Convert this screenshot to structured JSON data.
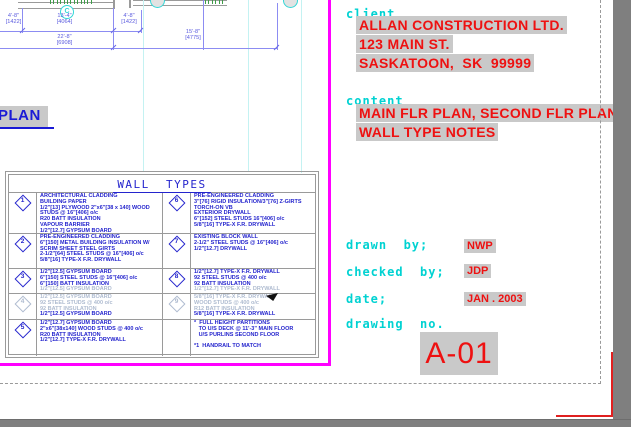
{
  "plan": {
    "title": "PLAN",
    "grid_bubble_label": "C",
    "dimensions": [
      {
        "label": "4'-8\"",
        "mm": "[1422]",
        "x": 0,
        "y": 13,
        "w": 27
      },
      {
        "label": "13'-4\"",
        "mm": "[4064]",
        "x": 42,
        "y": 13,
        "w": 45
      },
      {
        "label": "4'-8\"",
        "mm": "[1422]",
        "x": 115,
        "y": 13,
        "w": 28
      },
      {
        "label": "22'-8\"",
        "mm": "[6908]",
        "x": 42,
        "y": 34,
        "w": 45
      },
      {
        "label": "15'-8\"",
        "mm": "[4775]",
        "x": 170,
        "y": 29,
        "w": 46
      }
    ]
  },
  "wall_types": {
    "title": "WALL  TYPES",
    "rows": [
      {
        "h": 41,
        "left": {
          "num": "1",
          "lines": [
            {
              "t": "ARCHITECTURAL CLADDING"
            },
            {
              "t": "BUILDING PAPER"
            },
            {
              "t": "1/2\"[13] PLYWOOD 2\"x6\"[38 x 140] WOOD"
            },
            {
              "t": "STUDS @ 16\"[406] o/c"
            },
            {
              "t": "R20 BATT INSULATION"
            },
            {
              "t": "VAPOUR BARRIER"
            },
            {
              "t": "1/2\"[12.7] GYPSUM BOARD"
            }
          ]
        },
        "right": {
          "num": "6",
          "lines": [
            {
              "t": "PRE-ENGINEERED CLADDING"
            },
            {
              "t": "3\"[76] RIGID INSULATION/3\"[76] Z-GIRTS"
            },
            {
              "t": "TORCH-ON VB"
            },
            {
              "t": "EXTERIOR DRYWALL"
            },
            {
              "t": "6\"[152] STEEL STUDS 16\"[406] o/c"
            },
            {
              "t": "5/8\"[16] TYPE-X F.R. DRYWALL"
            }
          ]
        }
      },
      {
        "h": 35,
        "left": {
          "num": "2",
          "lines": [
            {
              "t": "PRE-ENGINEERED CLADDING"
            },
            {
              "t": "6\"[150] METAL BUILDING INSULATION W/"
            },
            {
              "t": "SCRIM SHEET STEEL GIRTS"
            },
            {
              "t": "2-1/2\"[64] STEEL STUDS @ 16\"[406] o/c"
            },
            {
              "t": "5/8\"[16] TYPE-X F.R. DRYWALL"
            }
          ]
        },
        "right": {
          "num": "7",
          "lines": [
            {
              "t": "EXISTING BLOCK WALL"
            },
            {
              "t": "2-1/2\" STEEL STUDS @ 16\"[406] o/c"
            },
            {
              "t": "1/2\"[12.7] DRYWALL"
            }
          ]
        }
      },
      {
        "h": 25,
        "left": {
          "num": "3",
          "lines": [
            {
              "t": "1/2\"[12.5] GYPSUM BOARD"
            },
            {
              "t": "6\"[150] STEEL STUDS @ 16\"[406] o/c"
            },
            {
              "t": "6\"[150] BATT INSULATION"
            },
            {
              "t": "1/2\"[12.5] GYPSUM BOARD",
              "f": true
            }
          ]
        },
        "right": {
          "num": "8",
          "lines": [
            {
              "t": "1/2\"[12.7] TYPE-X F.R. DRYWALL"
            },
            {
              "t": "92 STEEL STUDS @ 400 o/c"
            },
            {
              "t": "92 BATT INSULATION"
            },
            {
              "t": "1/2\"[12.7] TYPE-X F.R. DRYWALL",
              "f": true
            }
          ]
        }
      },
      {
        "h": 26,
        "left": {
          "num": "4",
          "num_faded": true,
          "lines": [
            {
              "t": "1/2\"[12.5] GYPSUM BOARD",
              "f": true
            },
            {
              "t": "92 STEEL STUDS @ 400 o/c",
              "f": true
            },
            {
              "t": "92 BATT INSULATION",
              "f": true
            },
            {
              "t": "1/2\"[12.5] GYPSUM BOARD"
            }
          ]
        },
        "right": {
          "num": "9",
          "num_faded": true,
          "lines": [
            {
              "t": "5/8\"[16] TYPE-X F.R. DRYWALL",
              "f": true
            },
            {
              "t": "WOOD STUDS @ 400 o/c",
              "f": true
            },
            {
              "t": "R12 BATT INSULATION",
              "f": true
            },
            {
              "t": "5/8\"[16] TYPE-X F.R. DRYWALL"
            }
          ]
        }
      },
      {
        "h": 36,
        "left": {
          "num": "5",
          "lines": [
            {
              "t": "1/2\"[12.7] GYPSUM BOARD"
            },
            {
              "t": "2\"x6\"[38x140] WOOD STUDS @ 400 o/c"
            },
            {
              "t": "R20 BATT INSULATION"
            },
            {
              "t": "1/2\"[12.7] TYPE-X F.R. DRYWALL"
            }
          ]
        },
        "right": {
          "num": null,
          "lines": [
            {
              "t": "*  FULL HEIGHT PARTITIONS"
            },
            {
              "t": "   TO U/S DECK @ 11'-3\" MAIN FLOOR"
            },
            {
              "t": "   U/S PURLINS SECOND FLOOR"
            },
            {
              "t": " "
            },
            {
              "t": "*1  HANDRAIL TO MATCH"
            }
          ]
        }
      }
    ]
  },
  "title_block": {
    "client_label": "client",
    "client_lines": [
      "ALLAN CONSTRUCTION LTD.",
      "123 MAIN ST.",
      "SASKATOON,  SK  99999"
    ],
    "content_label": "content",
    "content_lines": [
      "MAIN FLR PLAN, SECOND FLR PLAN,",
      "WALL TYPE NOTES"
    ],
    "drawn_by_label": "drawn  by;",
    "drawn_by": "NWP",
    "checked_by_label": "checked  by;",
    "checked_by": "JDP",
    "date_label": "date;",
    "date": "JAN . 2003",
    "drawing_no_label": "drawing  no.",
    "drawing_no": "A-01"
  },
  "colors": {
    "viewport_border": "#ff00ff",
    "annotation_blue": "#2424cd",
    "label_cyan": "#00d2d2",
    "value_red": "#ee1111",
    "highlight_gray": "#c9c9c9",
    "chrome_gray": "#7f7f7f"
  }
}
